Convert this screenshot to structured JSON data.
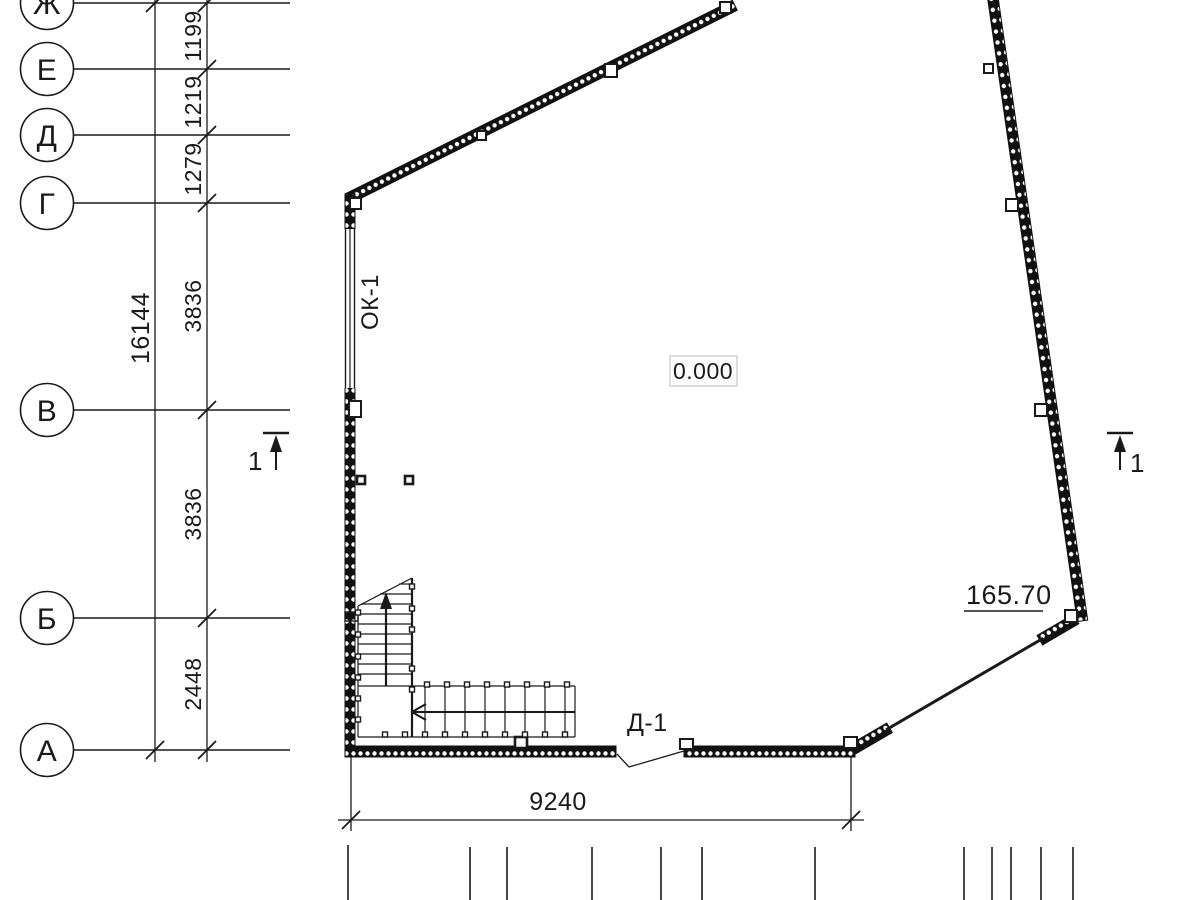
{
  "drawing": {
    "kind": "architectural floor plan",
    "grid": {
      "axes": [
        "Ж",
        "Е",
        "Д",
        "Г",
        "В",
        "Б",
        "А"
      ]
    },
    "dimensions": {
      "overall_height": "16144",
      "segments": [
        "1199",
        "1219",
        "1279",
        "3836",
        "3836",
        "2448"
      ],
      "bottom_width": "9240"
    },
    "labels": {
      "level_mark": "0.000",
      "elevation_mark": "165.70",
      "window_mark": "ОК-1",
      "door_mark": "Д-1",
      "section_mark": "1"
    },
    "palette": {
      "ink": "#1a1a1a",
      "background": "#ffffff",
      "level_box_border": "#c8c8c8"
    }
  }
}
